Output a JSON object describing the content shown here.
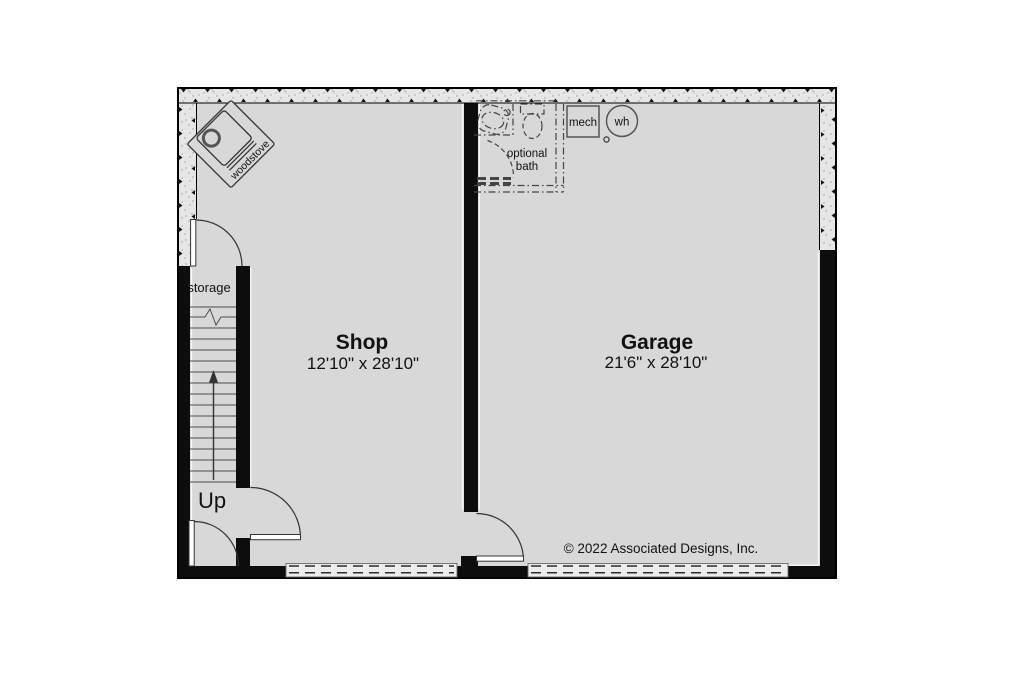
{
  "drawing": {
    "copyright": "© 2022 Associated Designs, Inc.",
    "rooms": {
      "shop": {
        "name": "Shop",
        "dims": "12'10\" x 28'10\""
      },
      "garage": {
        "name": "Garage",
        "dims": "21'6\" x 28'10\""
      },
      "storage": {
        "name": "storage"
      }
    },
    "stairs": {
      "direction_label": "Up"
    },
    "fixtures": {
      "woodstove": "woodstove",
      "optional_bath_line1": "optional",
      "optional_bath_line2": "bath",
      "mechanical": "mech",
      "water_heater": "wh"
    },
    "colors": {
      "floor": "#d8d8d8",
      "wall": "#0d0d0d",
      "hatch_bg": "#e6e6e6",
      "page_bg": "#ffffff"
    }
  }
}
